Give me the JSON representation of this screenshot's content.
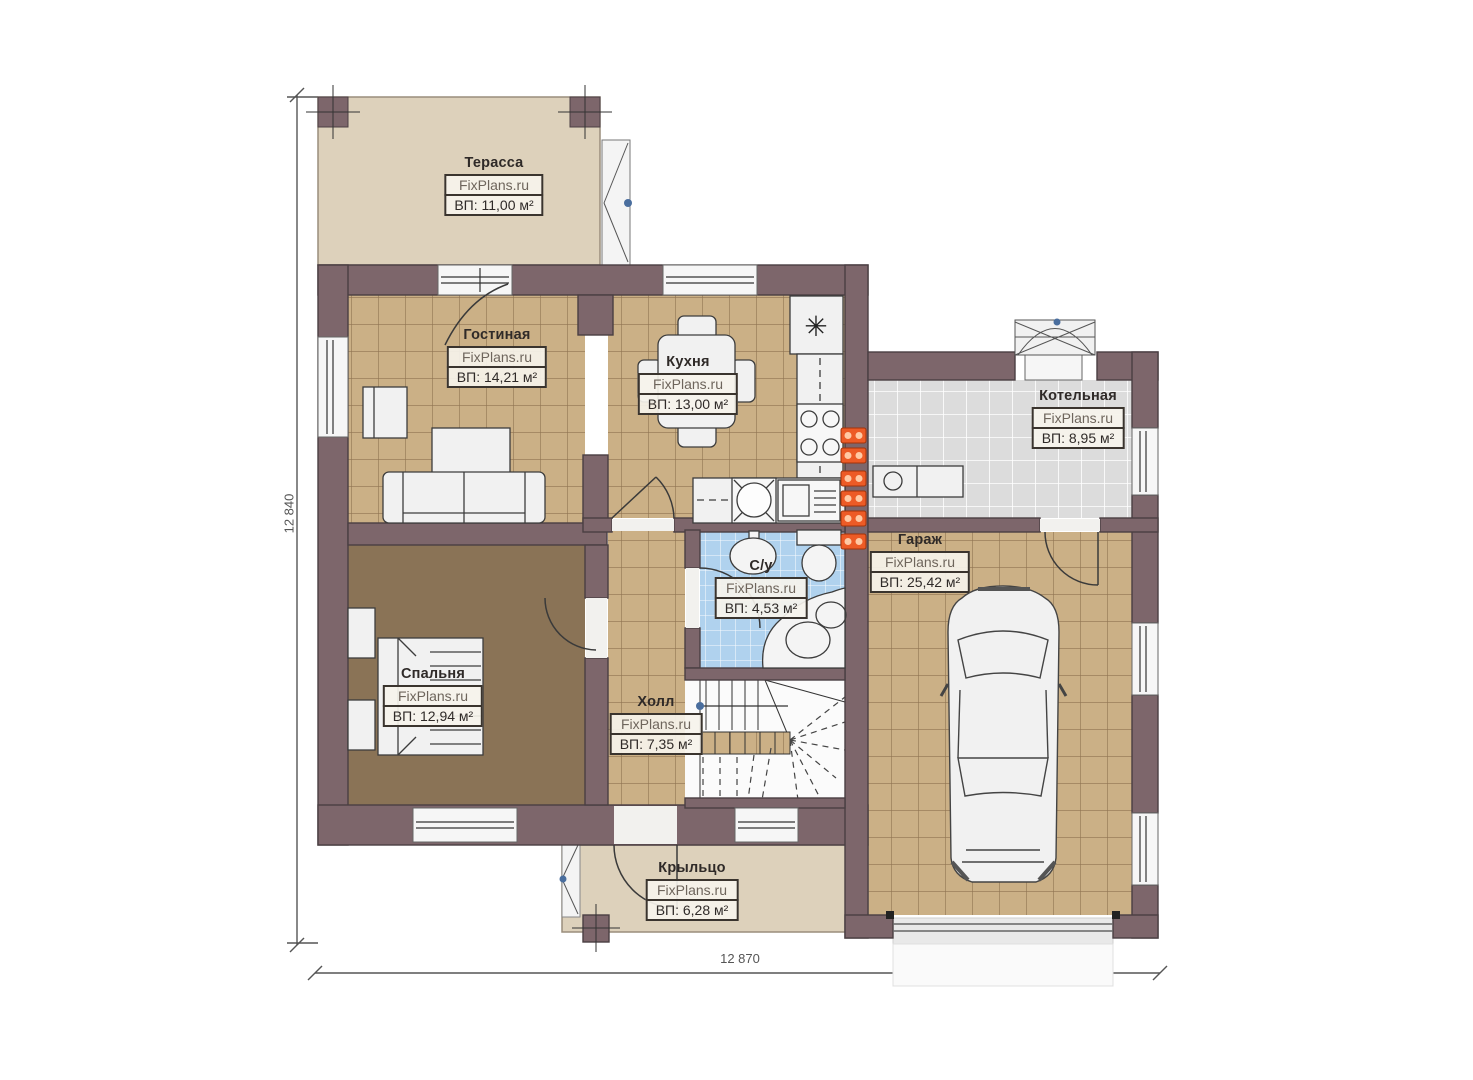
{
  "watermark": "FixPlans.ru",
  "dimensions": {
    "left": "12 840",
    "bottom": "12 870"
  },
  "rooms": [
    {
      "id": "terrace",
      "name": "Терасса",
      "area": "ВП: 11,00 м²"
    },
    {
      "id": "living",
      "name": "Гостиная",
      "area": "ВП: 14,21 м²"
    },
    {
      "id": "kitchen",
      "name": "Кухня",
      "area": "ВП: 13,00 м²"
    },
    {
      "id": "boiler",
      "name": "Котельная",
      "area": "ВП: 8,95 м²"
    },
    {
      "id": "garage",
      "name": "Гараж",
      "area": "ВП: 25,42 м²"
    },
    {
      "id": "bathroom",
      "name": "С/у",
      "area": "ВП: 4,53 м²"
    },
    {
      "id": "bedroom",
      "name": "Спальня",
      "area": "ВП: 12,94 м²"
    },
    {
      "id": "hall",
      "name": "Холл",
      "area": "ВП: 7,35 м²"
    },
    {
      "id": "porch",
      "name": "Крыльцо",
      "area": "ВП: 6,28 м²"
    }
  ],
  "icons": {
    "fridge": "✳"
  },
  "colors": {
    "wall": "#7d666b",
    "wall_edge": "#4a3f43",
    "terrace_floor": "#ddd1bb",
    "tile_tan": "#cbb086",
    "tile_tan_line": "#8f7351",
    "tile_gray": "#dcdcdc",
    "tile_blue": "#b0d2ee",
    "bedroom_floor": "#8a7356",
    "furniture": "#f1f1f1",
    "stroke": "#3a3a3a",
    "flue_orange": "#ed5b26",
    "marker_blue": "#4a6e9e",
    "dimension": "#555555"
  }
}
